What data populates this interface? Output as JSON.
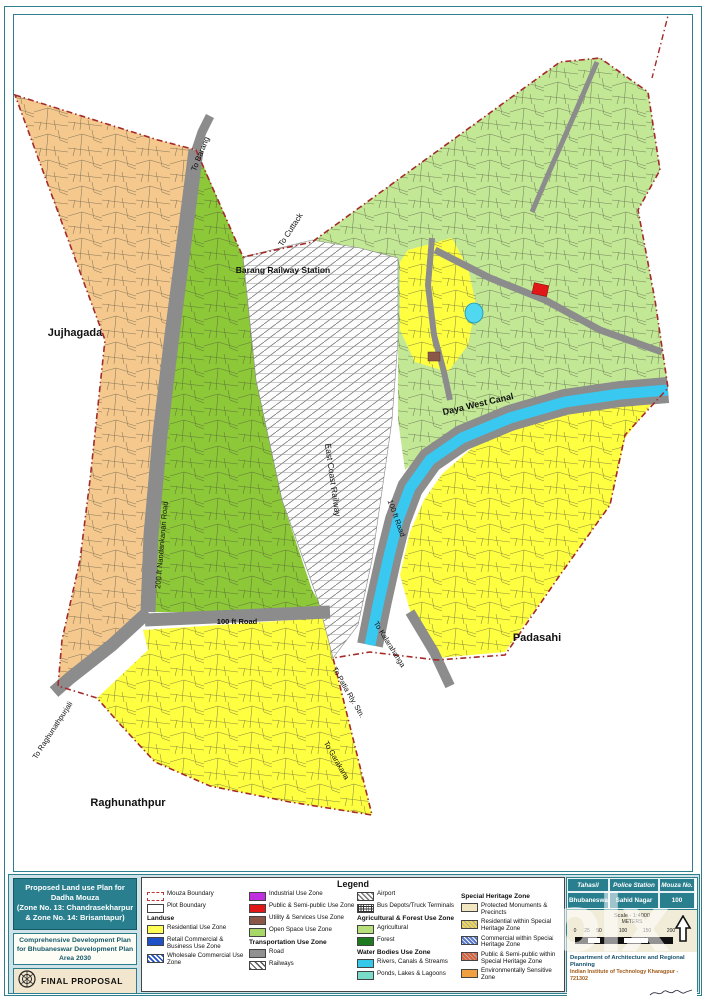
{
  "title_block": {
    "title_line1": "Proposed Land use Plan for Dadha Mouza",
    "title_line2": "(Zone No. 13: Chandrasekharpur & Zone No. 14: Brisantapur)",
    "subtitle": "Comprehensive Development Plan for Bhubaneswar Development Plan Area 2030",
    "final_label": "FINAL PROPOSAL"
  },
  "legend": {
    "title": "Legend",
    "col1": [
      {
        "label": "Mouza Boundary"
      },
      {
        "label": "Plot Boundary"
      },
      {
        "label": "Landuse"
      },
      {
        "label": "Residential Use Zone"
      },
      {
        "label": "Retail Commercial & Business Use Zone"
      },
      {
        "label": "Wholesale Commercial Use Zone"
      }
    ],
    "col2": [
      {
        "label": "Industrial Use Zone"
      },
      {
        "label": "Public & Semi-public Use Zone"
      },
      {
        "label": "Utility & Services Use Zone"
      },
      {
        "label": "Open Space Use Zone"
      },
      {
        "label": "Transportation Use Zone"
      },
      {
        "label": "Road"
      },
      {
        "label": "Railways"
      }
    ],
    "col3": [
      {
        "label": "Airport"
      },
      {
        "label": "Bus Depots/Truck Terminals"
      },
      {
        "label": "Agricultural & Forest Use Zone"
      },
      {
        "label": "Agricultural"
      },
      {
        "label": "Forest"
      },
      {
        "label": "Water Bodies Use Zone"
      },
      {
        "label": "Rivers, Canals & Streams"
      },
      {
        "label": "Ponds, Lakes & Lagoons"
      }
    ],
    "col4": [
      {
        "label": "Special Heritage Zone"
      },
      {
        "label": "Protected Monuments & Precincts"
      },
      {
        "label": "Residential within Special Heritage Zone"
      },
      {
        "label": "Commercial within Special Heritage Zone"
      },
      {
        "label": "Public & Semi-public within Special Heritage Zone"
      },
      {
        "label": "Environmentally Sensitive Zone"
      }
    ]
  },
  "info": {
    "table_headers": [
      "Tahasil",
      "Police Station",
      "Mouza No."
    ],
    "table_values": [
      "Bhubaneswar",
      "Sahid Nagar",
      "100"
    ],
    "scale_label": "Scale - 1:4000",
    "scale_units": "METERS",
    "scale_ticks": [
      "0",
      "25",
      "50",
      "100",
      "150",
      "200"
    ],
    "dept_line1": "Department of Architecture and Regional Planning",
    "dept_line2": "Indian Institute of Technology Kharagpur - 721302",
    "consultant": "Consultant-in-Charge",
    "professor": "Professor B.K. Sengupta"
  },
  "map": {
    "labels": [
      {
        "text": "Jujhagada"
      },
      {
        "text": "Padasahi"
      },
      {
        "text": "Raghunathpur"
      },
      {
        "text": "Barang Railway Station"
      },
      {
        "text": "To Cuttack"
      },
      {
        "text": "To Barang"
      },
      {
        "text": "Daya West Canal"
      },
      {
        "text": "East Coast Railway"
      },
      {
        "text": "100 ft Road"
      },
      {
        "text": "200 ft Nandankanan Road"
      },
      {
        "text": "100 ft Road"
      },
      {
        "text": "To Raghunathpurjali"
      },
      {
        "text": "To Patia Rly. Stn."
      },
      {
        "text": "To Garakana"
      },
      {
        "text": "To Kalarahanga"
      }
    ]
  },
  "watermark": "olx",
  "colors": {
    "teal": "#2a7f8e",
    "boundary_red": "#a52a2a",
    "residential_yellow": "#ffff42",
    "agricultural_green": "#8cc838",
    "agricultural_light_green": "#c2e896",
    "orchard_orange": "#f5c98e",
    "road_gray": "#8c8c8c",
    "canal_cyan": "#38c8f0",
    "public_red": "#e01818"
  }
}
